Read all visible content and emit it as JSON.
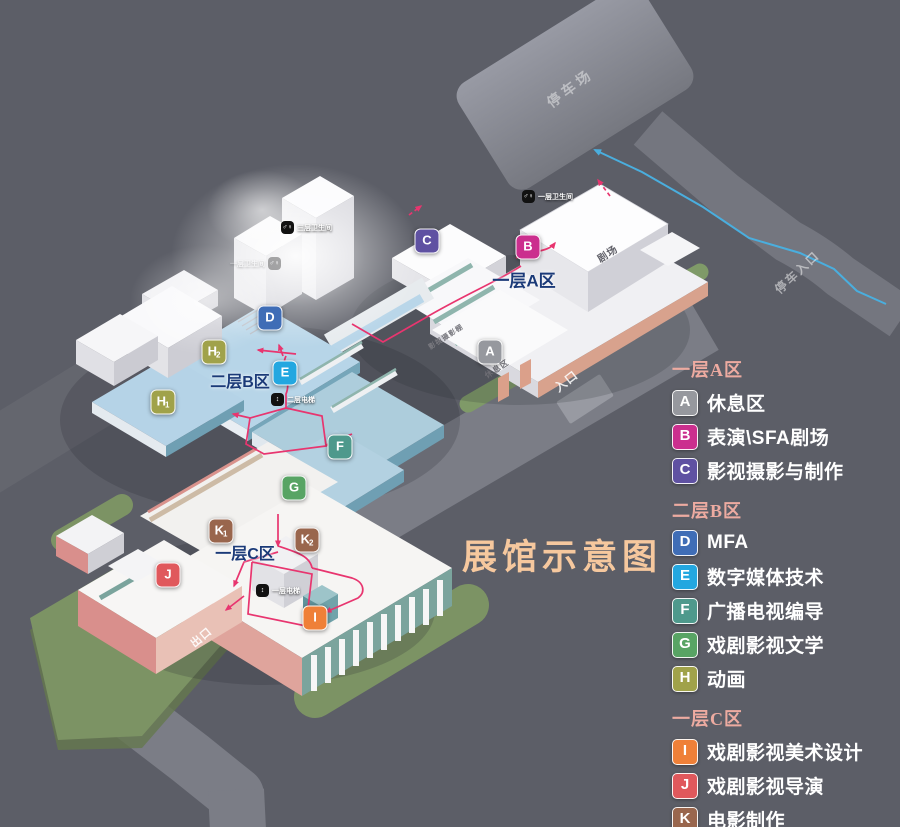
{
  "title": {
    "text": "展馆示意图",
    "color": "#f6c89e"
  },
  "colors": {
    "background": "#5c5e67",
    "zone_title": "#1b3a78",
    "legend_heading": "#edaba1",
    "route_pink": "#e8356f",
    "route_blue": "#4aaede"
  },
  "legend": {
    "sections": [
      {
        "heading": "一层A区",
        "items": [
          {
            "key": "A",
            "color": "#96989e",
            "label": "休息区"
          },
          {
            "key": "B",
            "color": "#cb2f8e",
            "label": "表演\\SFA剧场"
          },
          {
            "key": "C",
            "color": "#5f51a2",
            "label": "影视摄影与制作"
          }
        ]
      },
      {
        "heading": "二层B区",
        "items": [
          {
            "key": "D",
            "color": "#3f6db6",
            "label": "MFA"
          },
          {
            "key": "E",
            "color": "#23a7e0",
            "label": "数字媒体技术"
          },
          {
            "key": "F",
            "color": "#4e998c",
            "label": "广播电视编导"
          },
          {
            "key": "G",
            "color": "#58a464",
            "label": "戏剧影视文学"
          },
          {
            "key": "H",
            "color": "#a0a24a",
            "label": "动画"
          }
        ]
      },
      {
        "heading": "一层C区",
        "items": [
          {
            "key": "I",
            "color": "#ef8038",
            "label": "戏剧影视美术设计"
          },
          {
            "key": "J",
            "color": "#e0585c",
            "label": "戏剧影视导演"
          },
          {
            "key": "K",
            "color": "#99664d",
            "label": "电影制作"
          }
        ]
      }
    ]
  },
  "map": {
    "zone_titles": [
      {
        "name": "zone-title-a",
        "text": "一层A区",
        "x": 524,
        "y": 279,
        "size": 17
      },
      {
        "name": "zone-title-b",
        "text": "二层B区",
        "x": 240,
        "y": 380,
        "size": 16
      },
      {
        "name": "zone-title-c",
        "text": "一层C区",
        "x": 245,
        "y": 552,
        "size": 16
      }
    ],
    "badges": [
      {
        "key": "A",
        "x": 490,
        "y": 352,
        "color": "#96989e"
      },
      {
        "key": "B",
        "x": 528,
        "y": 247,
        "color": "#cb2f8e"
      },
      {
        "key": "C",
        "x": 427,
        "y": 241,
        "color": "#5f51a2"
      },
      {
        "key": "D",
        "x": 270,
        "y": 318,
        "color": "#3f6db6"
      },
      {
        "key": "E",
        "x": 285,
        "y": 373,
        "color": "#23a7e0"
      },
      {
        "key": "F",
        "x": 340,
        "y": 447,
        "color": "#4e998c"
      },
      {
        "key": "G",
        "x": 294,
        "y": 488,
        "color": "#58a464"
      },
      {
        "key": "H",
        "sub": "1",
        "x": 163,
        "y": 402,
        "color": "#a0a24a"
      },
      {
        "key": "H",
        "sub": "2",
        "x": 214,
        "y": 352,
        "color": "#a0a24a"
      },
      {
        "key": "I",
        "x": 315,
        "y": 618,
        "color": "#ef8038"
      },
      {
        "key": "J",
        "x": 168,
        "y": 575,
        "color": "#e0585c"
      },
      {
        "key": "K",
        "sub": "1",
        "x": 221,
        "y": 531,
        "color": "#99664d"
      },
      {
        "key": "K",
        "sub": "2",
        "x": 307,
        "y": 540,
        "color": "#99664d"
      }
    ],
    "facilities": [
      {
        "name": "restroom-1f",
        "icon": "restroom-icon",
        "glyph": "♂♀",
        "text": "一层卫生间",
        "x": 528,
        "y": 197,
        "side": "right",
        "opacity": 1
      },
      {
        "name": "restroom-3f",
        "icon": "restroom-icon",
        "glyph": "♂♀",
        "text": "三层卫生间",
        "x": 287,
        "y": 228,
        "side": "right",
        "opacity": 1
      },
      {
        "name": "restroom-ghost",
        "icon": "restroom-icon",
        "glyph": "♂♀",
        "text": "一层卫生间",
        "x": 268,
        "y": 264,
        "side": "left",
        "opacity": 0.35
      },
      {
        "name": "elevator-2f",
        "icon": "elevator-icon",
        "glyph": "↕",
        "text": "二层电梯",
        "x": 277,
        "y": 400,
        "side": "right",
        "opacity": 1
      },
      {
        "name": "elevator-1f",
        "icon": "elevator-icon",
        "glyph": "↕",
        "text": "一层电梯",
        "x": 262,
        "y": 591,
        "side": "right",
        "opacity": 1
      }
    ],
    "road_labels": [
      {
        "name": "parking-lot-label",
        "text": "停车场",
        "x": 570,
        "y": 88,
        "rot": -37,
        "size": 14,
        "spacing": 4,
        "color": "rgba(255,255,255,0.45)"
      },
      {
        "name": "parking-entrance-label",
        "text": "停车入口",
        "x": 797,
        "y": 272,
        "rot": -43,
        "size": 12,
        "spacing": 2,
        "color": "rgba(255,255,255,0.5)"
      },
      {
        "name": "entrance-label",
        "text": "入口",
        "x": 566,
        "y": 381,
        "rot": -38,
        "size": 12,
        "spacing": 1,
        "color": "rgba(255,255,255,0.85)"
      },
      {
        "name": "exit-label",
        "text": "出口",
        "x": 201,
        "y": 637,
        "rot": -40,
        "size": 11,
        "spacing": 1,
        "color": "rgba(255,255,255,0.9)"
      }
    ],
    "room_labels": [
      {
        "name": "theater-label",
        "text": "剧场",
        "x": 607,
        "y": 253,
        "rot": -33,
        "size": 10,
        "color": "#62626a"
      },
      {
        "name": "lounge-label",
        "text": "休息区",
        "x": 497,
        "y": 369,
        "rot": -33,
        "size": 8,
        "color": "#6d6d74"
      },
      {
        "name": "studio-label",
        "text": "影视摄影棚",
        "x": 446,
        "y": 337,
        "rot": -33,
        "size": 7,
        "color": "#7a7a80"
      }
    ]
  }
}
